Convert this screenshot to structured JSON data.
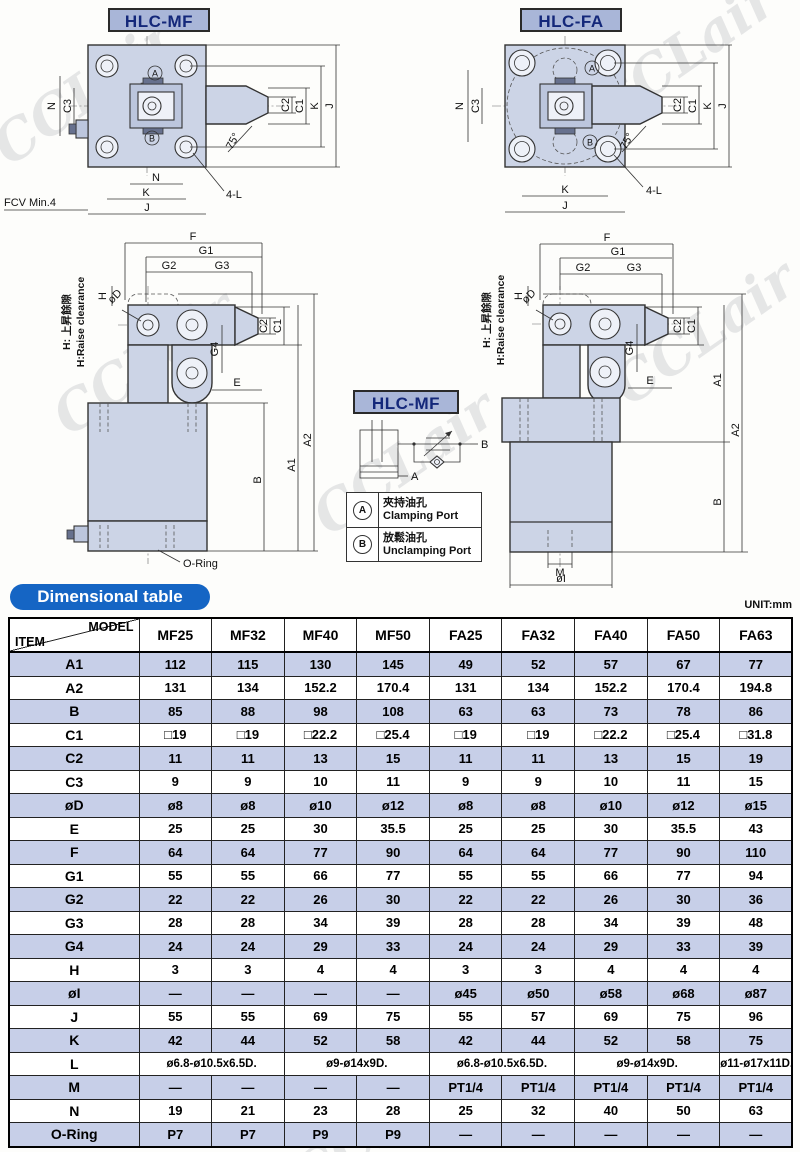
{
  "watermark": {
    "text": "CCLair"
  },
  "colors": {
    "accent_blue": "#1565c4",
    "row_shade": "#c7cfe8",
    "panel_blue": "#a9b6d8",
    "drawing_fill": "#ccd4e6"
  },
  "unit_label": "UNIT:mm",
  "section_title": "Dimensional table",
  "drawings": {
    "mf_top": {
      "title": "HLC-MF",
      "labels": {
        "port_a": "A",
        "port_b": "B",
        "n_left": "N",
        "c3": "C3",
        "c2": "C2",
        "c1": "C1",
        "k_right": "K",
        "j_right": "J",
        "angle": "75°",
        "n_bottom": "N",
        "k_bottom": "K",
        "j_bottom": "J",
        "four_l": "4-L",
        "fcv": "FCV Min.4"
      }
    },
    "fa_top": {
      "title": "HLC-FA",
      "labels": {
        "port_a": "A",
        "port_b": "B",
        "n_left": "N",
        "c3": "C3",
        "c2": "C2",
        "c1": "C1",
        "k_right": "K",
        "j_right": "J",
        "angle": "75°",
        "k_bottom": "K",
        "j_bottom": "J",
        "four_l": "4-L"
      }
    },
    "mf_side": {
      "labels": {
        "f": "F",
        "g1": "G1",
        "g2": "G2",
        "g3": "G3",
        "g4": "G4",
        "h": "H",
        "note_zh": "H: 上昇餘隙",
        "note_en": "H:Raise clearance",
        "od": "øD",
        "c2": "C2",
        "c1": "C1",
        "e": "E",
        "a1": "A1",
        "a2": "A2",
        "b": "B",
        "oring": "O-Ring"
      }
    },
    "fa_side": {
      "labels": {
        "f": "F",
        "g1": "G1",
        "g2": "G2",
        "g3": "G3",
        "g4": "G4",
        "h": "H",
        "note_zh": "H: 上昇餘隙",
        "note_en": "H:Raise clearance",
        "od": "øD",
        "c2": "C2",
        "c1": "C1",
        "e": "E",
        "a1": "A1",
        "a2": "A2",
        "b": "B",
        "m": "M",
        "oi": "øI"
      }
    },
    "schematic": {
      "title": "HLC-MF",
      "port_a": "A",
      "port_b": "B"
    },
    "legend": {
      "rows": [
        {
          "sym": "A",
          "zh": "夾持油孔",
          "en": "Clamping Port"
        },
        {
          "sym": "B",
          "zh": "放鬆油孔",
          "en": "Unclamping Port"
        }
      ]
    }
  },
  "table": {
    "corner_model": "MODEL",
    "corner_item": "ITEM",
    "models": [
      "MF25",
      "MF32",
      "MF40",
      "MF50",
      "FA25",
      "FA32",
      "FA40",
      "FA50",
      "FA63"
    ],
    "rows": [
      {
        "item": "A1",
        "cells": [
          "112",
          "115",
          "130",
          "145",
          "49",
          "52",
          "57",
          "67",
          "77"
        ]
      },
      {
        "item": "A2",
        "cells": [
          "131",
          "134",
          "152.2",
          "170.4",
          "131",
          "134",
          "152.2",
          "170.4",
          "194.8"
        ]
      },
      {
        "item": "B",
        "cells": [
          "85",
          "88",
          "98",
          "108",
          "63",
          "63",
          "73",
          "78",
          "86"
        ]
      },
      {
        "item": "C1",
        "cells": [
          "□19",
          "□19",
          "□22.2",
          "□25.4",
          "□19",
          "□19",
          "□22.2",
          "□25.4",
          "□31.8"
        ]
      },
      {
        "item": "C2",
        "cells": [
          "11",
          "11",
          "13",
          "15",
          "11",
          "11",
          "13",
          "15",
          "19"
        ]
      },
      {
        "item": "C3",
        "cells": [
          "9",
          "9",
          "10",
          "11",
          "9",
          "9",
          "10",
          "11",
          "15"
        ]
      },
      {
        "item": "øD",
        "cells": [
          "ø8",
          "ø8",
          "ø10",
          "ø12",
          "ø8",
          "ø8",
          "ø10",
          "ø12",
          "ø15"
        ]
      },
      {
        "item": "E",
        "cells": [
          "25",
          "25",
          "30",
          "35.5",
          "25",
          "25",
          "30",
          "35.5",
          "43"
        ]
      },
      {
        "item": "F",
        "cells": [
          "64",
          "64",
          "77",
          "90",
          "64",
          "64",
          "77",
          "90",
          "110"
        ]
      },
      {
        "item": "G1",
        "cells": [
          "55",
          "55",
          "66",
          "77",
          "55",
          "55",
          "66",
          "77",
          "94"
        ]
      },
      {
        "item": "G2",
        "cells": [
          "22",
          "22",
          "26",
          "30",
          "22",
          "22",
          "26",
          "30",
          "36"
        ]
      },
      {
        "item": "G3",
        "cells": [
          "28",
          "28",
          "34",
          "39",
          "28",
          "28",
          "34",
          "39",
          "48"
        ]
      },
      {
        "item": "G4",
        "cells": [
          "24",
          "24",
          "29",
          "33",
          "24",
          "24",
          "29",
          "33",
          "39"
        ]
      },
      {
        "item": "H",
        "cells": [
          "3",
          "3",
          "4",
          "4",
          "3",
          "3",
          "4",
          "4",
          "4"
        ]
      },
      {
        "item": "øI",
        "cells": [
          "—",
          "—",
          "—",
          "—",
          "ø45",
          "ø50",
          "ø58",
          "ø68",
          "ø87"
        ]
      },
      {
        "item": "J",
        "cells": [
          "55",
          "55",
          "69",
          "75",
          "55",
          "57",
          "69",
          "75",
          "96"
        ]
      },
      {
        "item": "K",
        "cells": [
          "42",
          "44",
          "52",
          "58",
          "42",
          "44",
          "52",
          "58",
          "75"
        ]
      },
      {
        "item": "L",
        "cells": [
          {
            "t": "ø6.8-ø10.5x6.5D.",
            "c": 2
          },
          {
            "t": "ø9-ø14x9D.",
            "c": 2
          },
          {
            "t": "ø6.8-ø10.5x6.5D.",
            "c": 2
          },
          {
            "t": "ø9-ø14x9D.",
            "c": 2
          },
          {
            "t": "ø11-ø17x11D.",
            "c": 1
          }
        ]
      },
      {
        "item": "M",
        "cells": [
          "—",
          "—",
          "—",
          "—",
          "PT1/4",
          "PT1/4",
          "PT1/4",
          "PT1/4",
          "PT1/4"
        ]
      },
      {
        "item": "N",
        "cells": [
          "19",
          "21",
          "23",
          "28",
          "25",
          "32",
          "40",
          "50",
          "63"
        ]
      },
      {
        "item": "O-Ring",
        "cells": [
          "P7",
          "P7",
          "P9",
          "P9",
          "—",
          "—",
          "—",
          "—",
          "—"
        ]
      }
    ]
  }
}
